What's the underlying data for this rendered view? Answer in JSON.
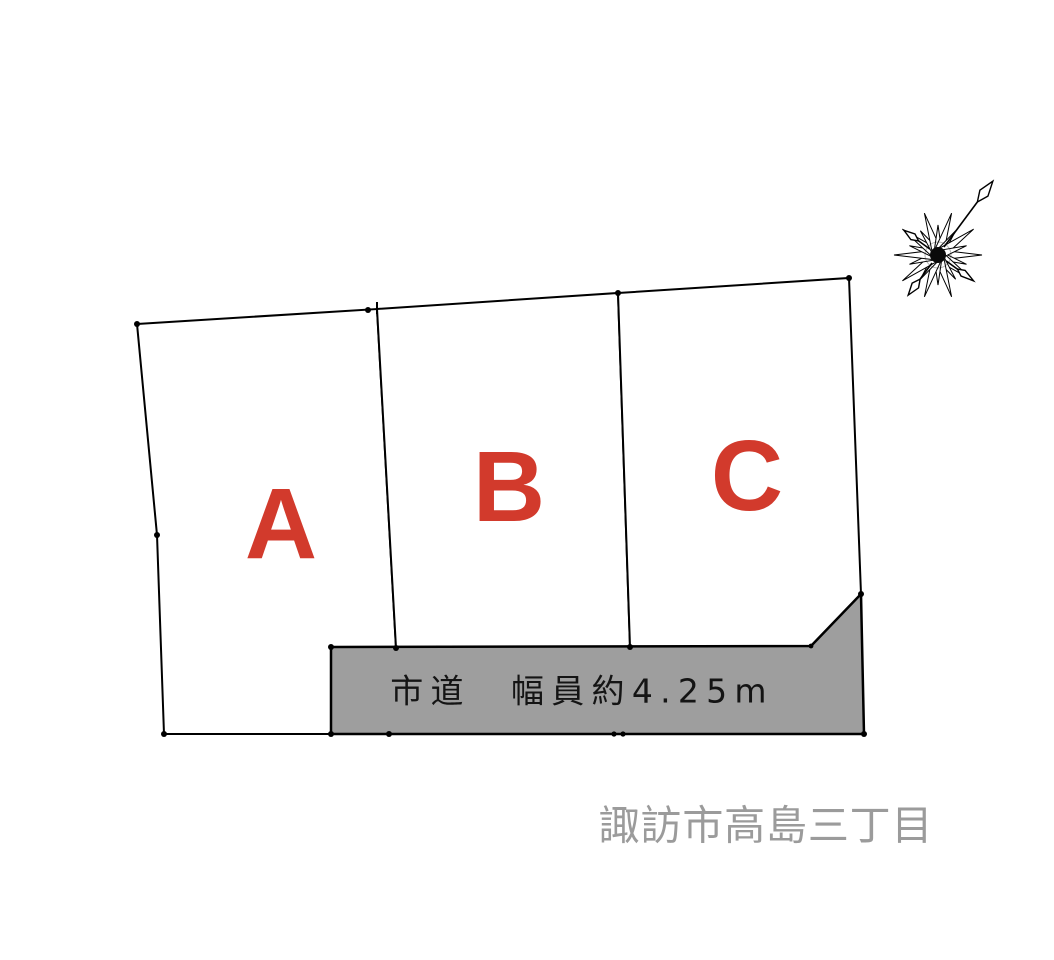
{
  "plots": [
    {
      "id": "A",
      "label": "A"
    },
    {
      "id": "B",
      "label": "B"
    },
    {
      "id": "C",
      "label": "C"
    }
  ],
  "road": {
    "label": "市道　幅員約4.25m",
    "type": "city-road",
    "width_note": "約4.25m"
  },
  "address": {
    "label": "諏訪市高島三丁目"
  },
  "compass": {
    "name": "compass-rose",
    "north_direction": "upper-right"
  },
  "colors": {
    "plot_label": "#d23a2c",
    "road_fill": "#9e9e9e",
    "road_text": "#141414",
    "address_text": "#9b9b9b",
    "outline": "#000000",
    "background": "#ffffff"
  }
}
